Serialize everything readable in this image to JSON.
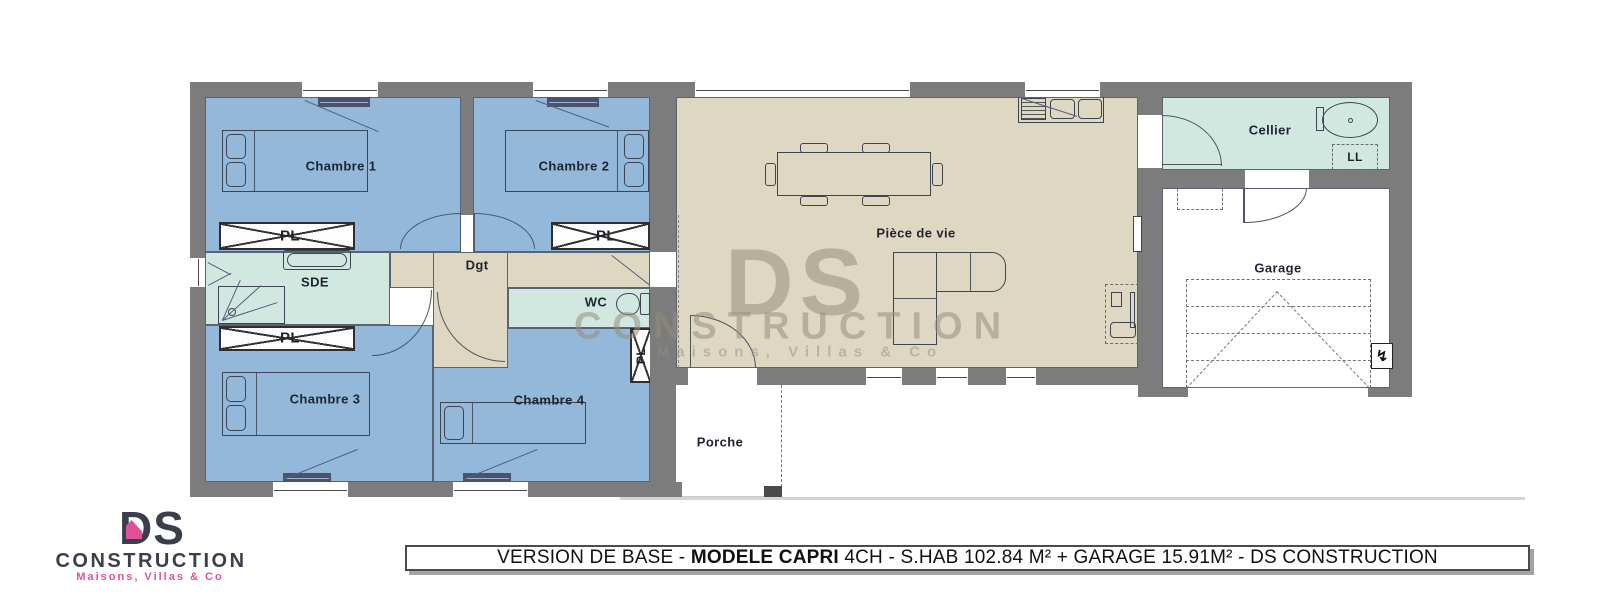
{
  "plan_title": "Plan de maison plain-pied",
  "rooms": {
    "chambre1": "Chambre 1",
    "chambre2": "Chambre 2",
    "chambre3": "Chambre 3",
    "chambre4": "Chambre 4",
    "sde": "SDE",
    "dgt": "Dgt",
    "wc": "WC",
    "piece_de_vie": "Pièce de vie",
    "cellier": "Cellier",
    "garage": "Garage",
    "porche": "Porche",
    "pl": "PL",
    "ll": "LL"
  },
  "banner": {
    "part1": "VERSION DE BASE - ",
    "bold": "MODELE CAPRI",
    "part2": " 4CH - S.HAB 102.84 M² + GARAGE 15.91M² - DS CONSTRUCTION"
  },
  "logo": {
    "ds": "DS",
    "construction": "CONSTRUCTION",
    "tagline": "Maisons, Villas & Co"
  },
  "watermark": {
    "ds": "DS",
    "construction": "CONSTRUCTION",
    "tagline": "Maisons, Villas & Co"
  },
  "icons": {
    "electrical_panel": "↯"
  },
  "colors": {
    "wall": "#7c7c7c",
    "bedroom_blue": "#93b8da",
    "living_beige": "#ded8c3",
    "wet_room_green": "#d1e8e1",
    "furniture_line": "#3d4454",
    "label_text": "#1f2530",
    "logo_dark": "#3a3f4b",
    "logo_pink": "#e2509a",
    "watermark": "#968e7c",
    "banner_border": "#4b4b4b"
  }
}
